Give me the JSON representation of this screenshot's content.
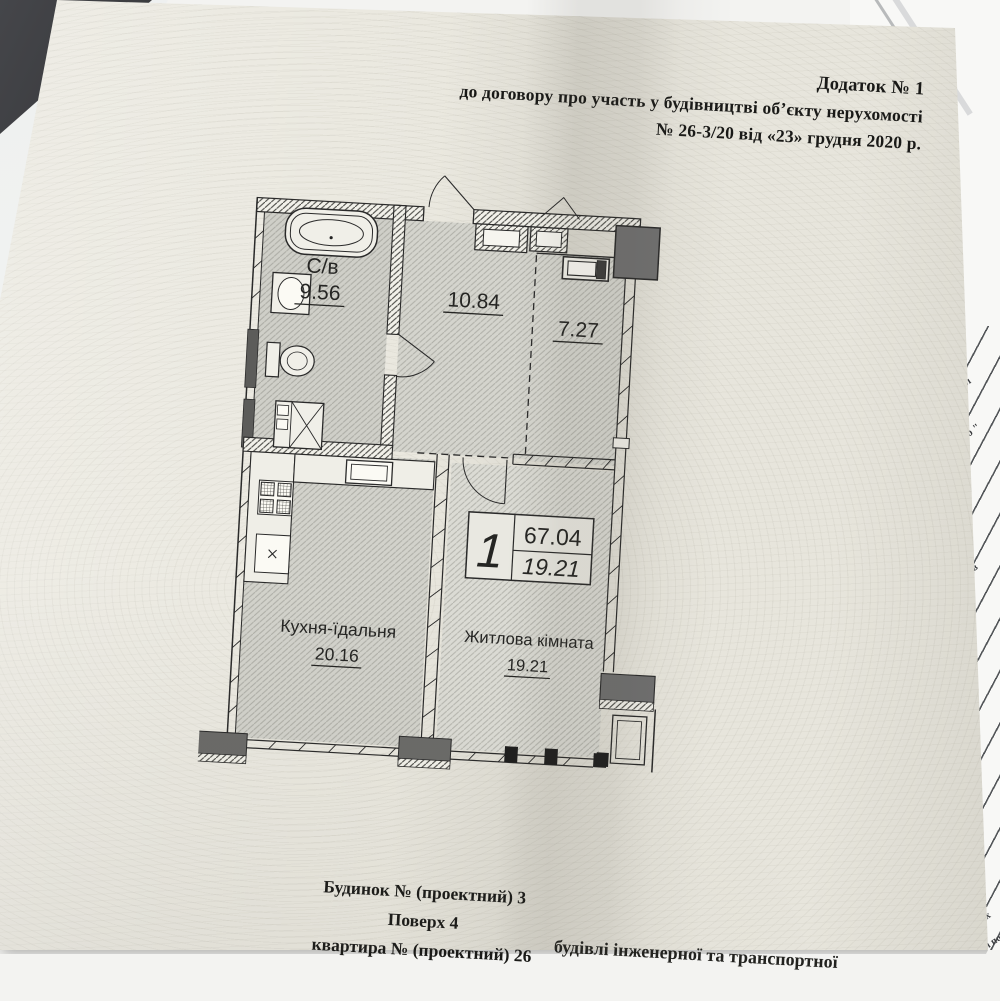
{
  "document": {
    "header": {
      "line1": "Додаток № 1",
      "line2": "до договору  про участь у будівництві об’єкту нерухомості",
      "line3": "№ 26-3/20  від «23» грудня 2020 р."
    },
    "footer": {
      "building": "Будинок № (проектний) 3",
      "floor": "Поверх 4",
      "apartment": "квартира № (проектний)  26",
      "clipped_line": "будівлі інженерної та транспортної"
    }
  },
  "floor_plan": {
    "rooms": [
      {
        "label": "С/в",
        "area": "9.56"
      },
      {
        "label": "",
        "area": "10.84"
      },
      {
        "label": "",
        "area": "7.27"
      },
      {
        "label": "Кухня-їдальня",
        "area": "20.16"
      },
      {
        "label": "Житлова кімната",
        "area": "19.21"
      }
    ],
    "summary_box": {
      "room_count": "1",
      "total_area": "67.04",
      "living_area": "19.21"
    }
  },
  "background_papers": {
    "fragments": {
      "f1": "накл",
      "f2": "стю \"",
      "f3": "відв",
      "f4": "7",
      "f5": "их",
      "f6": "і по"
    }
  },
  "colors": {
    "paper": "#eae8df",
    "desk": "#232528",
    "plan_line": "#2a2a2a",
    "handwriting_blue": "#4a4f9d"
  }
}
